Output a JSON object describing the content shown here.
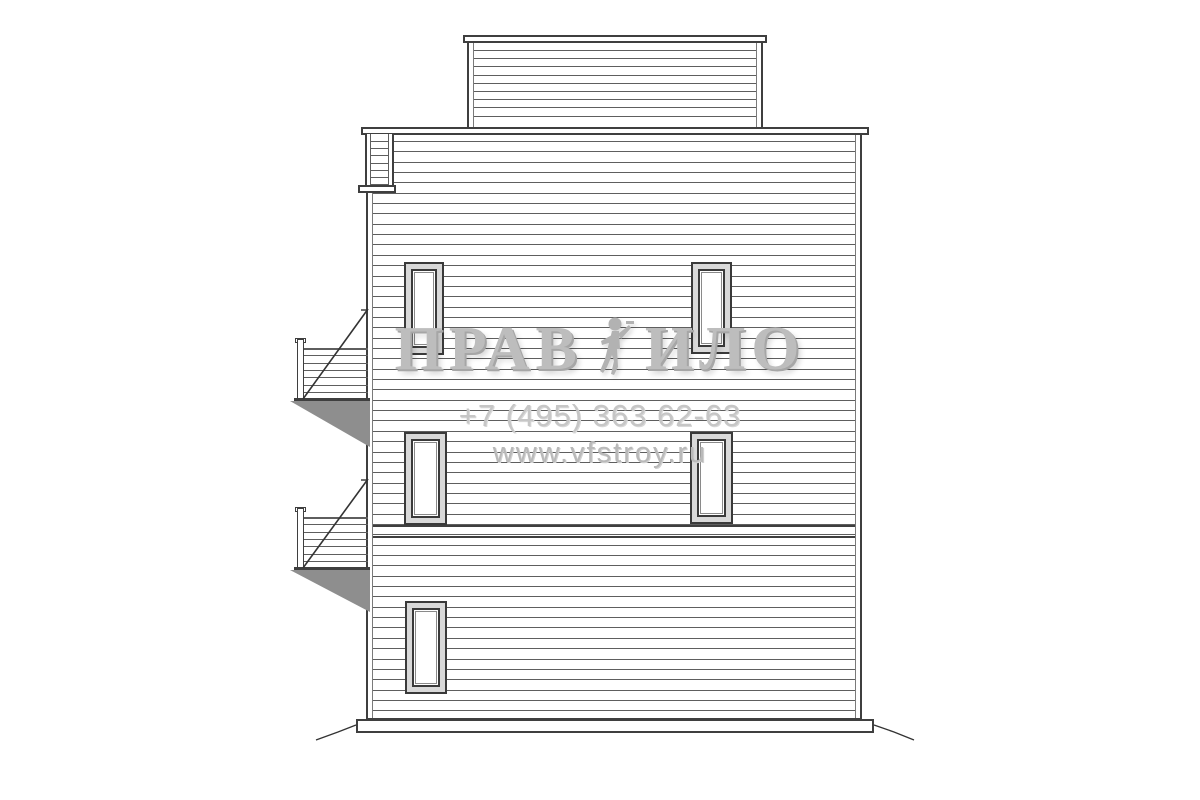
{
  "watermark": {
    "title_left": "ПРАВ",
    "title_right": "ИЛО",
    "phone": "+7 (495) 363 62-63",
    "website": "www.vfstroy.ru",
    "figure_icon": "worker-figure"
  },
  "colors": {
    "frame": "#3f3f3f",
    "siding_line": "#5e5e5e",
    "trim_line": "#7a7a7a",
    "shade": "#8e8e8e",
    "diag_line": "#333333",
    "watermark_title": "#bdbdbd",
    "watermark_phone": "#c6c6c6",
    "watermark_site": "#b9b9b9",
    "background": "#ffffff"
  },
  "elevation": {
    "description": "side elevation drawing of a three-storey house with horizontal siding, roof-deck ladder and two balcony stair landings",
    "top_section": {
      "x": 467,
      "y": 42,
      "width": 296,
      "height": 86,
      "siding_spacing": 8.2,
      "first_line": 8,
      "cap": {
        "x": 463,
        "y": 35,
        "width": 304,
        "height": 8
      }
    },
    "main_wall": {
      "x": 366,
      "y": 134,
      "width": 496,
      "height": 586,
      "siding_spacing": 10.35,
      "first_line": 7,
      "cap": {
        "x": 361,
        "y": 127,
        "width": 508,
        "height": 8
      },
      "band_lines": [
        391,
        402
      ]
    },
    "base": {
      "x": 356,
      "y": 719,
      "width": 518,
      "height": 14
    },
    "ladder": {
      "x": 365,
      "y": 134,
      "width": 29,
      "height": 56,
      "rungs": 7,
      "rung_start": 7,
      "rung_spacing": 7.2,
      "ledge": {
        "x": 358,
        "y": 185,
        "width": 38,
        "height": 8
      }
    },
    "windows": [
      {
        "x": 404,
        "y": 262,
        "width": 40,
        "height": 93
      },
      {
        "x": 691,
        "y": 262,
        "width": 41,
        "height": 92
      },
      {
        "x": 404,
        "y": 432,
        "width": 43,
        "height": 93
      },
      {
        "x": 690,
        "y": 432,
        "width": 43,
        "height": 92
      },
      {
        "x": 405,
        "y": 601,
        "width": 42,
        "height": 93
      }
    ],
    "balconies": [
      {
        "post_x": 297,
        "post_top": 339,
        "floor_y": 398,
        "rail_lines": 7,
        "rail_spacing": 7.3,
        "right_x": 368,
        "diag_top_y": 309,
        "shade_depth": 46
      },
      {
        "post_x": 297,
        "post_top": 508,
        "floor_y": 567,
        "rail_lines": 7,
        "rail_spacing": 7.3,
        "right_x": 368,
        "diag_top_y": 479,
        "shade_depth": 42
      }
    ],
    "ground_lines": [
      {
        "points": "356,725 338,732 316,740"
      },
      {
        "points": "874,725 894,732 914,740"
      }
    ]
  }
}
